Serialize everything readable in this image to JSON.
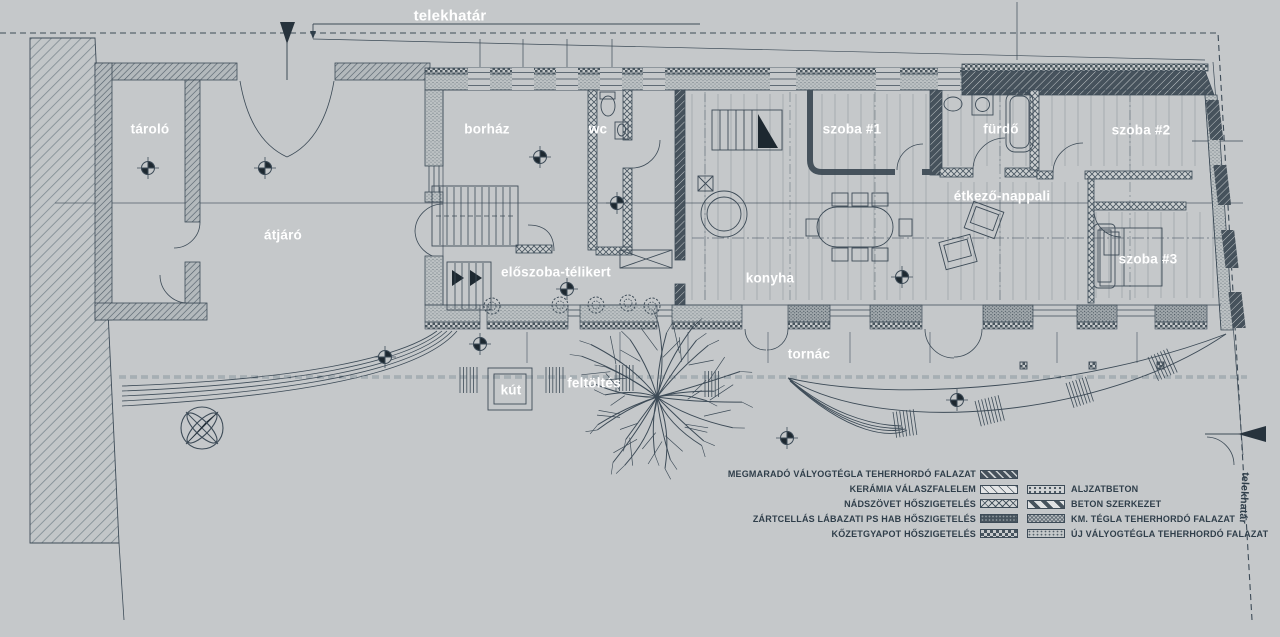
{
  "plan": {
    "boundary_label_top": "telekhatár",
    "boundary_label_right": "telekhatár"
  },
  "rooms": {
    "tarolo": "tároló",
    "atjaro": "átjáró",
    "borhaz": "borház",
    "wc": "wc",
    "eloszoba": "előszoba-télikert",
    "szoba1": "szoba #1",
    "furdo": "fürdő",
    "szoba2": "szoba #2",
    "etkezo": "étkező-nappali",
    "konyha": "konyha",
    "szoba3": "szoba #3",
    "tornac": "tornác",
    "kut": "kút",
    "feltoltes": "feltöltés"
  },
  "legend": {
    "left": [
      {
        "label": "MEGMARADÓ VÁLYOGTÉGLA TEHERHORDÓ FALAZAT",
        "pattern": "diag-dark-hatch"
      },
      {
        "label": "KERÁMIA VÁLASZFALELEM",
        "pattern": "thin-diagonal-lines"
      },
      {
        "label": "NÁDSZÖVET HŐSZIGETELÉS",
        "pattern": "diamond-crosshatch"
      },
      {
        "label": "ZÁRTCELLÁS LÁBAZATI PS HAB HŐSZIGETELÉS",
        "pattern": "dense-dark-dots"
      },
      {
        "label": "KŐZETGYAPOT HŐSZIGETELÉS",
        "pattern": "checkerboard"
      }
    ],
    "right": [
      {
        "label": "ALJZATBETON",
        "pattern": "dot-stipple"
      },
      {
        "label": "BETON SZERKEZET",
        "pattern": "wide-diagonal-stripes"
      },
      {
        "label": "KM. TÉGLA TEHERHORDÓ FALAZAT",
        "pattern": "fine-crosshatch"
      },
      {
        "label": "ÚJ VÁLYOGTÉGLA TEHERHORDÓ FALAZAT",
        "pattern": "light-stipple"
      }
    ]
  },
  "colors": {
    "background": "#c5c8ca",
    "ink": "#3d4b57",
    "dark_wall": "#46525c",
    "label_text": "#ffffff",
    "legend_text": "#2f3e4a"
  }
}
